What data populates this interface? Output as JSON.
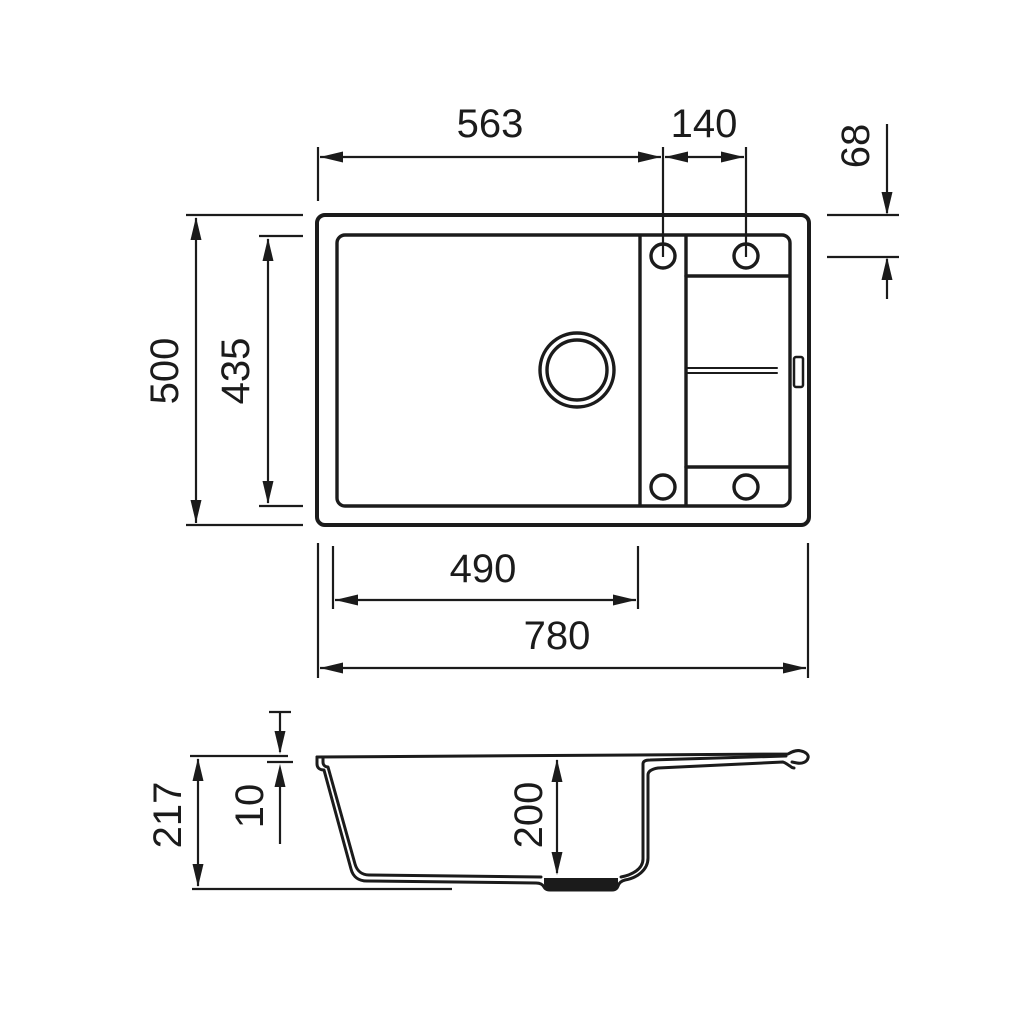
{
  "drawing": {
    "kind": "sink-technical-drawing",
    "background": "#ffffff",
    "line_color": "#1b1b1b",
    "views": {
      "top": {
        "name": "top-view-plan"
      },
      "side": {
        "name": "side-section-view"
      }
    },
    "dimensions": {
      "top": {
        "edge_to_first_hole": "563",
        "hole_spacing": "140",
        "edge_to_hole_vertical": "68",
        "overall_depth": "500",
        "inner_depth": "435",
        "bowl_width": "490",
        "overall_width": "780"
      },
      "side": {
        "overall_height": "217",
        "rim_thickness": "10",
        "bowl_depth": "200"
      }
    }
  }
}
